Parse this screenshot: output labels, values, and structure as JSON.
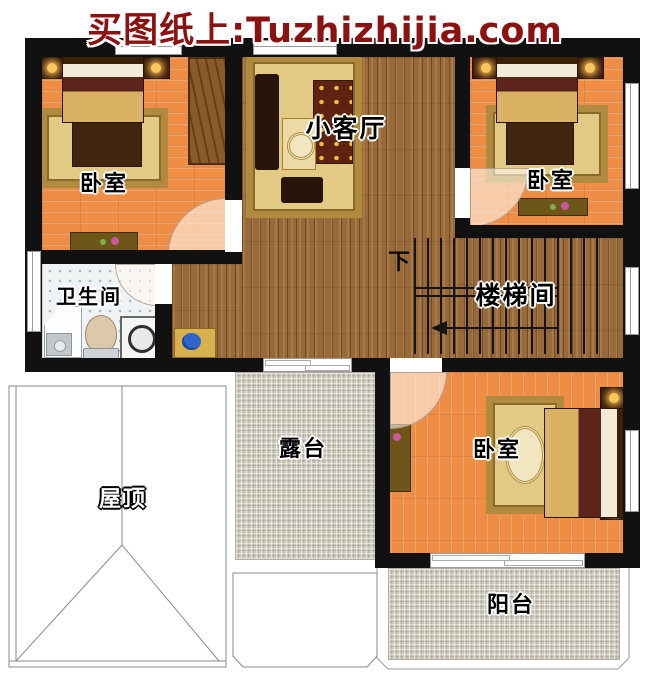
{
  "watermark": {
    "text": "买图纸上:Tuzhizhijia.com"
  },
  "rooms": {
    "bedroom_top_left": {
      "label": "卧室"
    },
    "living_room": {
      "label": "小客厅"
    },
    "bedroom_top_right": {
      "label": "卧室"
    },
    "bathroom": {
      "label": "卫生间"
    },
    "stairwell": {
      "label": "楼梯间",
      "direction_label": "下"
    },
    "terrace": {
      "label": "露台"
    },
    "roof": {
      "label": "屋顶"
    },
    "bedroom_bottom": {
      "label": "卧室"
    },
    "balcony": {
      "label": "阳台"
    }
  },
  "colors": {
    "watermark-red": "#8b1210",
    "wall-black": "#111111",
    "floor-orange": "#ee8d43",
    "floor-brown": "#996a39",
    "tile-gray": "#ccc8ba",
    "tile-bath": "#f0f3f4",
    "rug-gold": "#e2c984",
    "rug-border": "#b08a3e"
  }
}
